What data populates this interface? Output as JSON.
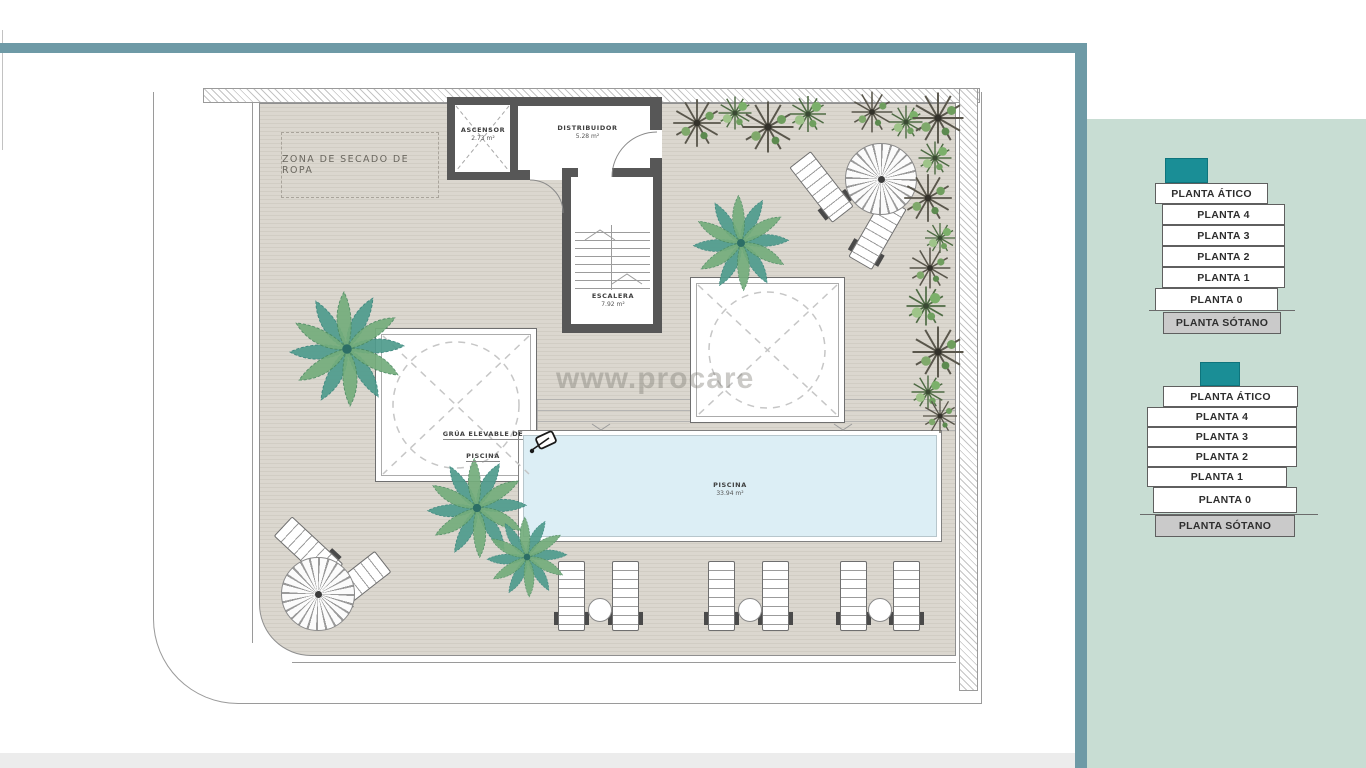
{
  "plan": {
    "watermark": "www.procare",
    "labels": {
      "zona_secado": "ZONA DE SECADO DE ROPA",
      "ascensor": {
        "name": "ASCENSOR",
        "area": "2.73 m²"
      },
      "distribuidor": {
        "name": "DISTRIBUIDOR",
        "area": "5.28 m²"
      },
      "escalera": {
        "name": "ESCALERA",
        "area": "7.92 m²"
      },
      "grua": "GRÚA ELEVABLE DE PISCINA",
      "piscina": {
        "name": "PISCINA",
        "area": "33.94 m²"
      }
    }
  },
  "floor_selector": {
    "stacks": [
      {
        "buttons": [
          "PLANTA ÁTICO",
          "PLANTA 4",
          "PLANTA 3",
          "PLANTA 2",
          "PLANTA 1",
          "PLANTA 0",
          "PLANTA SÓTANO"
        ]
      },
      {
        "buttons": [
          "PLANTA ÁTICO",
          "PLANTA 4",
          "PLANTA 3",
          "PLANTA 2",
          "PLANTA 1",
          "PLANTA 0",
          "PLANTA SÓTANO"
        ]
      }
    ]
  },
  "colors": {
    "accent_teal": "#1a8e96",
    "frame_bar": "#6e9aa6",
    "panel_background": "#c8ddd3",
    "pool_water": "#dceef5",
    "basement_button": "#cacaca"
  }
}
